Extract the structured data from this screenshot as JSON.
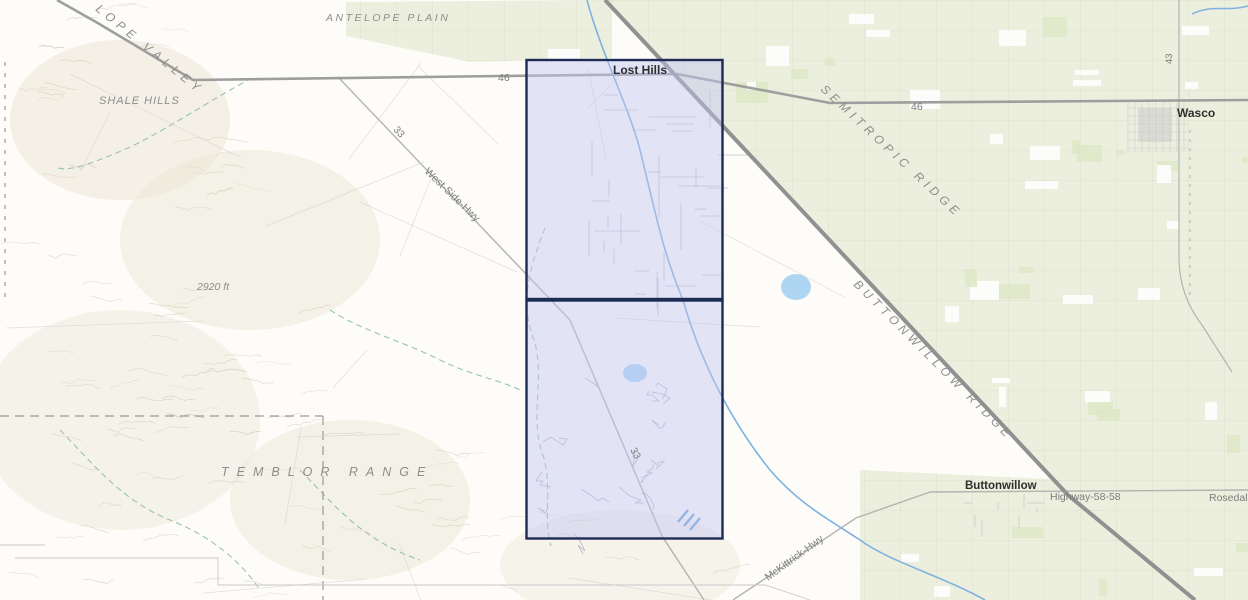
{
  "map": {
    "towns": {
      "lost_hills": "Lost Hills",
      "wasco": "Wasco",
      "buttonwillow": "Buttonwillow"
    },
    "regions": {
      "antelope_plain": "ANTELOPE PLAIN",
      "antelope_valley": "LOPE VALLEY",
      "shale_hills": "SHALE HILLS",
      "temblor_range": "TEMBLOR RANGE",
      "semitropic_ridge": "SEMITROPIC RIDGE",
      "buttonwillow_ridge": "BUTTONWILLOW RIDGE"
    },
    "roads": {
      "hwy46_west": "46",
      "hwy46_east": "46",
      "route33_north": "33",
      "route33_south": "33",
      "route43": "43",
      "west_side_hwy": "West-Side-Hwy",
      "mckittrick_hwy": "McKittrick-Hwy",
      "highway_58": "Highway-58-58",
      "rosedale": "Rosedale"
    },
    "labels": {
      "elevation": "2920 ft"
    },
    "colors": {
      "selection_fill": "#c2c6f2",
      "selection_border": "#1d2c55",
      "farmland": "#ecefdd",
      "water": "#7fb2e0",
      "road_major": "#919191",
      "terrain": "#fdfcf8"
    }
  }
}
